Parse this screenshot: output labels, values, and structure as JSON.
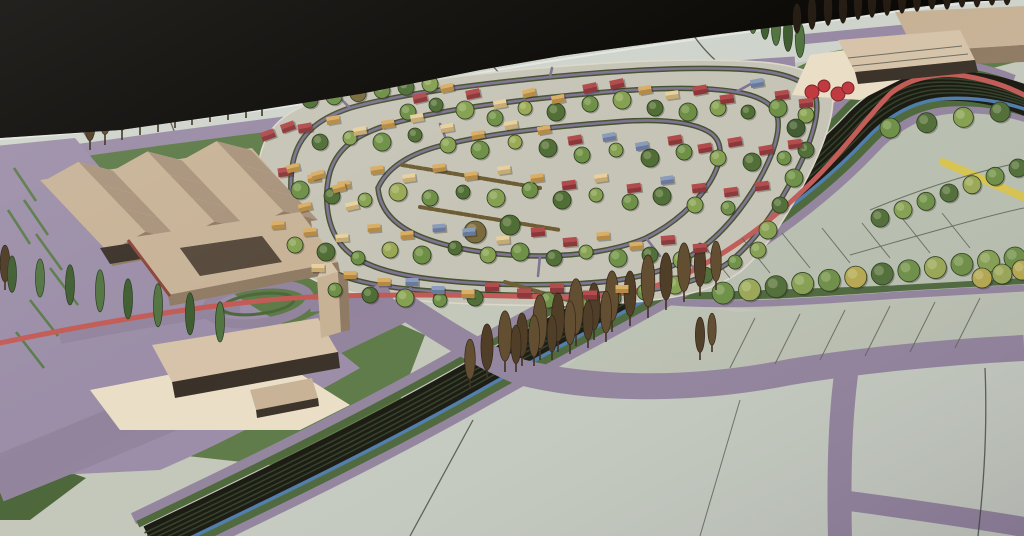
{
  "palette": {
    "sky": "#0b0906",
    "board_base": "#c3c7ba",
    "back_band": "#ced3cb",
    "field_right": "#b9c0b0",
    "field_bottom": "#c6ccc1",
    "purple_road": "#93849e",
    "purple_strip": "#988aa4",
    "grass": "#5d7a47",
    "grass_dark": "#4c673a",
    "rail_dark": "#17170f",
    "rail_line": "#2f3d25",
    "canal_blue": "#4d7cab",
    "red_road": "#c25a55",
    "yellow_road": "#d8c54e",
    "plaza_cream": "#eadfc6",
    "building_tan": "#c7b296",
    "building_tan_light": "#d6c3a9",
    "building_side": "#8f7a63",
    "building_front_dark": "#3a3128",
    "tree_tones": [
      "#3f5a30",
      "#4f6d35",
      "#6d8f45",
      "#85a050",
      "#9aa854",
      "#b7a94e",
      "#7a6a3c"
    ],
    "poplar_browns": [
      "#4c3a22",
      "#5f4a2c"
    ],
    "cypress_greens": [
      "#3f5c30",
      "#527440"
    ],
    "silhouette": "#241c12",
    "sculpture_red": "#c0393f",
    "house_colors": {
      "red": [
        "#b14a4b",
        "#8c3538"
      ],
      "yellow": [
        "#d9ad63",
        "#b58942"
      ],
      "cream": [
        "#e7d09d",
        "#c6aa72"
      ],
      "blue": [
        "#8a9cba",
        "#68799e"
      ]
    },
    "hedge_brown": "#6d5c33"
  },
  "scene": {
    "corridor_path": "M150,540 C250,492 360,440 470,378 C560,327 640,288 710,243 C770,205 820,165 855,128 C878,103 905,88 935,86 C975,84 1005,92 1030,102",
    "corridor_bands": [
      {
        "k": -27,
        "w": 12,
        "color": "#93849e"
      },
      {
        "k": 28,
        "w": 11,
        "color": "#93849e"
      },
      {
        "k": -20,
        "w": 7,
        "color": "#4c673a"
      },
      {
        "k": 21,
        "w": 8,
        "color": "#4c673a"
      },
      {
        "k": 0,
        "w": 30,
        "color": "#17170f"
      },
      {
        "k": -9,
        "w": 1.6,
        "color": "#2f3d25"
      },
      {
        "k": -4.5,
        "w": 1.6,
        "color": "#2f3d25"
      },
      {
        "k": 0,
        "w": 1.6,
        "color": "#2f3d25"
      },
      {
        "k": 4.5,
        "w": 1.6,
        "color": "#2f3d25"
      },
      {
        "k": 9,
        "w": 1.6,
        "color": "#2f3d25"
      },
      {
        "k": 16,
        "w": 3.5,
        "color": "#4d7cab"
      }
    ],
    "houses": [
      [
        420,
        98,
        -12,
        "red"
      ],
      [
        447,
        88,
        -12,
        "yellow"
      ],
      [
        473,
        94,
        -12,
        "red"
      ],
      [
        500,
        104,
        -10,
        "cream"
      ],
      [
        529,
        93,
        -14,
        "yellow"
      ],
      [
        558,
        99,
        -10,
        "yellow"
      ],
      [
        590,
        88,
        -12,
        "red"
      ],
      [
        617,
        84,
        -12,
        "red"
      ],
      [
        645,
        90,
        -10,
        "yellow"
      ],
      [
        672,
        95,
        -8,
        "cream"
      ],
      [
        700,
        90,
        -10,
        "red"
      ],
      [
        727,
        99,
        -8,
        "red"
      ],
      [
        757,
        83,
        -10,
        "blue"
      ],
      [
        782,
        95,
        -8,
        "red"
      ],
      [
        806,
        103,
        -6,
        "red"
      ],
      [
        305,
        128,
        -10,
        "red"
      ],
      [
        333,
        120,
        -10,
        "yellow"
      ],
      [
        360,
        131,
        -10,
        "cream"
      ],
      [
        388,
        124,
        -10,
        "yellow"
      ],
      [
        417,
        118,
        -10,
        "cream"
      ],
      [
        447,
        128,
        -10,
        "cream"
      ],
      [
        478,
        135,
        -10,
        "yellow"
      ],
      [
        511,
        125,
        -10,
        "cream"
      ],
      [
        544,
        130,
        -10,
        "yellow"
      ],
      [
        575,
        140,
        -10,
        "red"
      ],
      [
        609,
        137,
        -10,
        "blue"
      ],
      [
        642,
        146,
        -10,
        "blue"
      ],
      [
        675,
        140,
        -10,
        "red"
      ],
      [
        705,
        148,
        -10,
        "red"
      ],
      [
        735,
        142,
        -10,
        "red"
      ],
      [
        766,
        150,
        -10,
        "red"
      ],
      [
        795,
        144,
        -8,
        "red"
      ],
      [
        285,
        172,
        -8,
        "red"
      ],
      [
        314,
        178,
        -8,
        "yellow"
      ],
      [
        344,
        185,
        -8,
        "yellow"
      ],
      [
        377,
        170,
        -8,
        "yellow"
      ],
      [
        409,
        178,
        -8,
        "cream"
      ],
      [
        439,
        168,
        -8,
        "yellow"
      ],
      [
        471,
        176,
        -8,
        "yellow"
      ],
      [
        504,
        170,
        -8,
        "cream"
      ],
      [
        537,
        178,
        -8,
        "yellow"
      ],
      [
        569,
        185,
        -8,
        "red"
      ],
      [
        601,
        178,
        -8,
        "cream"
      ],
      [
        634,
        188,
        -8,
        "red"
      ],
      [
        667,
        180,
        -8,
        "blue"
      ],
      [
        699,
        188,
        -8,
        "red"
      ],
      [
        731,
        192,
        -8,
        "red"
      ],
      [
        762,
        186,
        -8,
        "red"
      ],
      [
        278,
        225,
        -5,
        "yellow"
      ],
      [
        310,
        232,
        -5,
        "yellow"
      ],
      [
        342,
        238,
        -5,
        "cream"
      ],
      [
        374,
        228,
        -5,
        "yellow"
      ],
      [
        407,
        235,
        -5,
        "yellow"
      ],
      [
        439,
        228,
        -5,
        "blue"
      ],
      [
        469,
        232,
        -5,
        "blue"
      ],
      [
        503,
        240,
        -5,
        "cream"
      ],
      [
        538,
        232,
        -5,
        "red"
      ],
      [
        570,
        242,
        -5,
        "red"
      ],
      [
        603,
        236,
        -5,
        "yellow"
      ],
      [
        636,
        246,
        -5,
        "yellow"
      ],
      [
        668,
        240,
        -5,
        "red"
      ],
      [
        700,
        248,
        -5,
        "red"
      ],
      [
        318,
        268,
        0,
        "cream"
      ],
      [
        350,
        275,
        0,
        "yellow"
      ],
      [
        384,
        282,
        0,
        "yellow"
      ],
      [
        412,
        282,
        0,
        "blue"
      ],
      [
        438,
        290,
        0,
        "blue"
      ],
      [
        468,
        294,
        0,
        "yellow"
      ],
      [
        492,
        287,
        0,
        "red"
      ],
      [
        524,
        293,
        0,
        "red"
      ],
      [
        557,
        288,
        0,
        "red"
      ],
      [
        590,
        295,
        0,
        "red"
      ],
      [
        622,
        289,
        0,
        "yellow"
      ],
      [
        268,
        135,
        -20,
        "red"
      ],
      [
        288,
        127,
        -20,
        "red"
      ],
      [
        293,
        168,
        -15,
        "yellow"
      ],
      [
        318,
        175,
        -15,
        "yellow"
      ],
      [
        339,
        188,
        -15,
        "yellow"
      ],
      [
        305,
        207,
        -15,
        "yellow"
      ],
      [
        352,
        206,
        -12,
        "cream"
      ]
    ],
    "trees": [
      [
        408,
        112,
        8,
        2
      ],
      [
        436,
        105,
        7,
        1
      ],
      [
        465,
        110,
        9,
        3
      ],
      [
        495,
        118,
        8,
        2
      ],
      [
        525,
        108,
        7,
        4
      ],
      [
        556,
        112,
        9,
        1
      ],
      [
        590,
        104,
        8,
        2
      ],
      [
        622,
        100,
        9,
        3
      ],
      [
        655,
        108,
        8,
        1
      ],
      [
        688,
        112,
        9,
        2
      ],
      [
        718,
        108,
        8,
        3
      ],
      [
        748,
        112,
        7,
        1
      ],
      [
        778,
        108,
        9,
        2
      ],
      [
        806,
        115,
        8,
        3
      ],
      [
        320,
        142,
        8,
        1
      ],
      [
        350,
        138,
        7,
        3
      ],
      [
        382,
        142,
        9,
        2
      ],
      [
        415,
        135,
        7,
        1
      ],
      [
        448,
        145,
        8,
        3
      ],
      [
        480,
        150,
        9,
        2
      ],
      [
        515,
        142,
        7,
        4
      ],
      [
        548,
        148,
        9,
        1
      ],
      [
        582,
        155,
        8,
        2
      ],
      [
        616,
        150,
        7,
        3
      ],
      [
        650,
        158,
        9,
        1
      ],
      [
        684,
        152,
        8,
        2
      ],
      [
        718,
        158,
        8,
        3
      ],
      [
        752,
        162,
        9,
        1
      ],
      [
        784,
        158,
        7,
        2
      ],
      [
        300,
        190,
        9,
        2
      ],
      [
        332,
        196,
        8,
        1
      ],
      [
        365,
        200,
        7,
        3
      ],
      [
        398,
        192,
        9,
        4
      ],
      [
        430,
        198,
        8,
        2
      ],
      [
        463,
        192,
        7,
        1
      ],
      [
        496,
        198,
        9,
        3
      ],
      [
        530,
        190,
        8,
        2
      ],
      [
        562,
        200,
        9,
        1
      ],
      [
        596,
        195,
        7,
        3
      ],
      [
        630,
        202,
        8,
        2
      ],
      [
        662,
        196,
        9,
        1
      ],
      [
        695,
        205,
        8,
        3
      ],
      [
        728,
        208,
        7,
        2
      ],
      [
        295,
        245,
        8,
        3
      ],
      [
        326,
        252,
        9,
        1
      ],
      [
        358,
        258,
        7,
        2
      ],
      [
        390,
        250,
        8,
        4
      ],
      [
        422,
        255,
        9,
        2
      ],
      [
        455,
        248,
        7,
        1
      ],
      [
        488,
        255,
        8,
        3
      ],
      [
        520,
        252,
        9,
        2
      ],
      [
        554,
        258,
        8,
        1
      ],
      [
        586,
        252,
        7,
        3
      ],
      [
        618,
        258,
        9,
        2
      ],
      [
        650,
        255,
        8,
        1
      ],
      [
        682,
        260,
        9,
        3
      ],
      [
        335,
        290,
        7,
        2
      ],
      [
        370,
        295,
        8,
        1
      ],
      [
        405,
        298,
        9,
        3
      ],
      [
        440,
        300,
        7,
        2
      ],
      [
        475,
        298,
        8,
        1
      ],
      [
        548,
        300,
        8,
        2
      ],
      [
        580,
        302,
        7,
        3
      ],
      [
        612,
        298,
        9,
        1
      ],
      [
        645,
        292,
        8,
        2
      ],
      [
        675,
        285,
        9,
        3
      ],
      [
        705,
        275,
        8,
        1
      ],
      [
        735,
        262,
        7,
        2
      ],
      [
        758,
        250,
        8,
        3
      ],
      [
        475,
        232,
        11,
        6
      ],
      [
        510,
        225,
        10,
        1
      ],
      [
        796,
        128,
        9,
        0
      ],
      [
        806,
        150,
        8,
        1
      ],
      [
        794,
        178,
        9,
        2
      ],
      [
        780,
        205,
        8,
        1
      ],
      [
        768,
        230,
        9,
        3
      ]
    ],
    "tree_rows": [
      {
        "x1": 723,
        "y1": 293,
        "x2": 1015,
        "y2": 258,
        "n": 12,
        "r": 11,
        "tones": [
          2,
          4,
          1,
          3,
          2,
          5,
          1,
          2,
          4,
          2,
          3,
          2
        ]
      },
      {
        "x1": 880,
        "y1": 218,
        "x2": 1018,
        "y2": 168,
        "n": 7,
        "r": 9,
        "tones": [
          1,
          3,
          2,
          1,
          4,
          2,
          1
        ]
      },
      {
        "x1": 890,
        "y1": 128,
        "x2": 1000,
        "y2": 112,
        "n": 4,
        "r": 10,
        "tones": [
          2,
          1,
          3,
          1
        ]
      },
      {
        "x1": 982,
        "y1": 278,
        "x2": 1022,
        "y2": 270,
        "n": 3,
        "r": 10,
        "tones": [
          5,
          4,
          5
        ]
      },
      {
        "x1": 310,
        "y1": 100,
        "x2": 430,
        "y2": 84,
        "n": 6,
        "r": 8,
        "tones": [
          1,
          2,
          6,
          2,
          1,
          3
        ]
      }
    ],
    "poplars": [
      [
        90,
        150,
        52
      ],
      [
        105,
        145,
        58
      ],
      [
        122,
        140,
        54
      ],
      [
        140,
        135,
        60
      ],
      [
        158,
        132,
        56
      ],
      [
        175,
        128,
        62
      ],
      [
        192,
        125,
        58
      ],
      [
        210,
        122,
        55
      ],
      [
        228,
        120,
        60
      ],
      [
        246,
        118,
        52
      ],
      [
        262,
        116,
        56
      ],
      [
        470,
        388,
        48
      ],
      [
        487,
        380,
        55
      ],
      [
        505,
        372,
        60
      ],
      [
        522,
        366,
        52
      ],
      [
        540,
        360,
        64
      ],
      [
        558,
        352,
        58
      ],
      [
        576,
        346,
        66
      ],
      [
        594,
        340,
        56
      ],
      [
        612,
        332,
        60
      ],
      [
        630,
        326,
        54
      ],
      [
        648,
        318,
        62
      ],
      [
        666,
        310,
        56
      ],
      [
        684,
        302,
        58
      ],
      [
        700,
        296,
        52
      ],
      [
        716,
        290,
        48
      ],
      [
        516,
        372,
        46
      ],
      [
        534,
        366,
        50
      ],
      [
        552,
        360,
        44
      ],
      [
        570,
        354,
        52
      ],
      [
        588,
        348,
        46
      ],
      [
        606,
        342,
        50
      ],
      [
        700,
        360,
        42
      ],
      [
        712,
        352,
        38
      ],
      [
        5,
        290,
        44
      ]
    ],
    "cypresses": [
      [
        12,
        295,
        38
      ],
      [
        40,
        300,
        40
      ],
      [
        70,
        308,
        42
      ],
      [
        100,
        315,
        44
      ],
      [
        128,
        322,
        42
      ],
      [
        158,
        330,
        45
      ],
      [
        190,
        338,
        44
      ],
      [
        220,
        345,
        42
      ],
      [
        742,
        30,
        34
      ],
      [
        753,
        36,
        36
      ],
      [
        765,
        42,
        38
      ],
      [
        776,
        48,
        36
      ],
      [
        788,
        54,
        38
      ],
      [
        800,
        60,
        36
      ]
    ],
    "silhouettes": [
      [
        797,
        32,
        30
      ],
      [
        812,
        28,
        34
      ],
      [
        828,
        24,
        36
      ],
      [
        843,
        22,
        32
      ],
      [
        858,
        18,
        38
      ],
      [
        872,
        16,
        34
      ],
      [
        887,
        14,
        36
      ],
      [
        902,
        12,
        32
      ],
      [
        917,
        10,
        34
      ],
      [
        932,
        8,
        30
      ],
      [
        947,
        8,
        32
      ],
      [
        962,
        6,
        30
      ],
      [
        977,
        6,
        28
      ],
      [
        992,
        4,
        30
      ],
      [
        1007,
        4,
        26
      ]
    ],
    "sculptures": [
      [
        812,
        92,
        7
      ],
      [
        824,
        86,
        6
      ],
      [
        838,
        94,
        7
      ],
      [
        848,
        88,
        6
      ]
    ],
    "hedges": [
      [
        402,
        165,
        540,
        188
      ],
      [
        420,
        207,
        560,
        230
      ],
      [
        505,
        282,
        588,
        306
      ]
    ]
  }
}
